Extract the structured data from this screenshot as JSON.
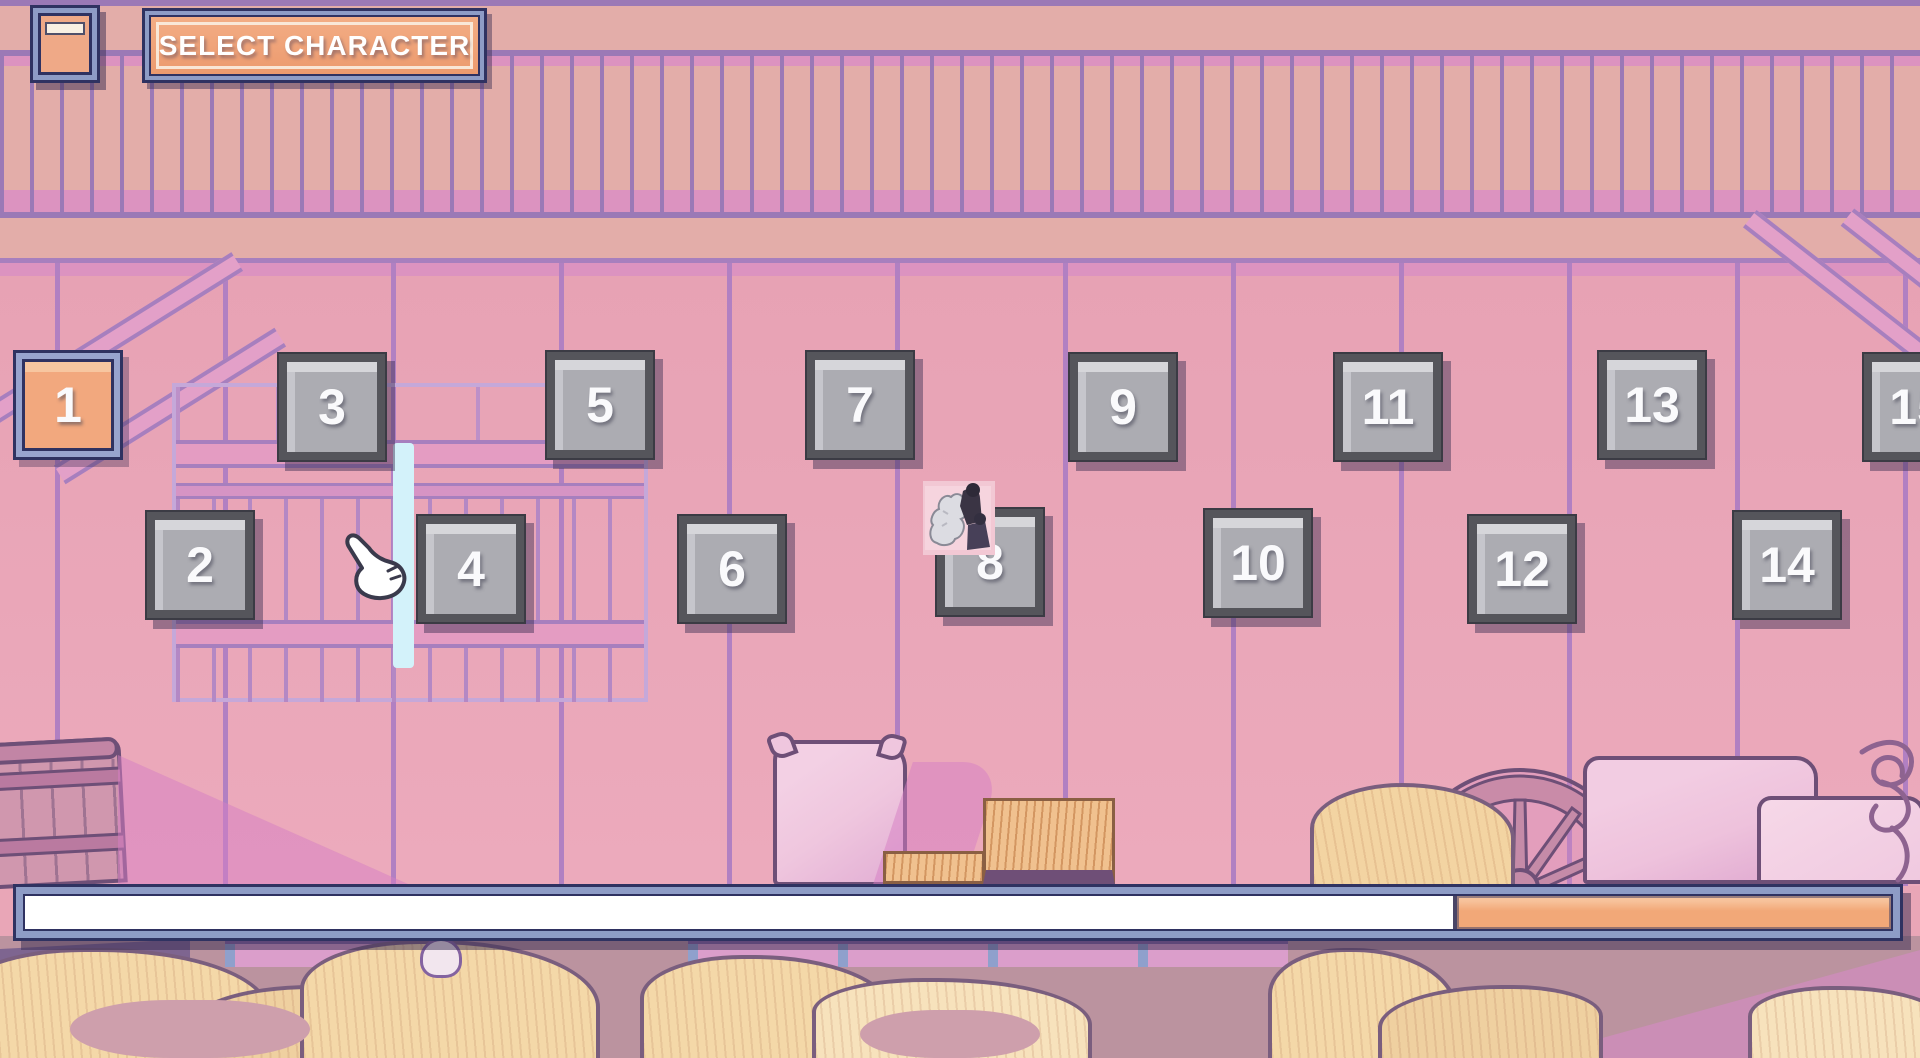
{
  "screen": {
    "name": "character-select",
    "width": 1920,
    "height": 1058
  },
  "header": {
    "menu_button": {
      "icon": "hamburger-icon"
    },
    "title_plate": {
      "label": "SELECT CHARACTER"
    }
  },
  "tiles": [
    {
      "number": "1",
      "selected": true,
      "left": 13,
      "top": 350
    },
    {
      "number": "2",
      "selected": false,
      "left": 145,
      "top": 510
    },
    {
      "number": "3",
      "selected": false,
      "left": 277,
      "top": 352
    },
    {
      "number": "4",
      "selected": false,
      "left": 416,
      "top": 514
    },
    {
      "number": "5",
      "selected": false,
      "left": 545,
      "top": 350
    },
    {
      "number": "6",
      "selected": false,
      "left": 677,
      "top": 514
    },
    {
      "number": "7",
      "selected": false,
      "left": 805,
      "top": 350
    },
    {
      "number": "8",
      "selected": false,
      "left": 935,
      "top": 507
    },
    {
      "number": "9",
      "selected": false,
      "left": 1068,
      "top": 352
    },
    {
      "number": "10",
      "selected": false,
      "left": 1203,
      "top": 508
    },
    {
      "number": "11",
      "selected": false,
      "left": 1333,
      "top": 352
    },
    {
      "number": "12",
      "selected": false,
      "left": 1467,
      "top": 514
    },
    {
      "number": "13",
      "selected": false,
      "left": 1597,
      "top": 350
    },
    {
      "number": "14",
      "selected": false,
      "left": 1732,
      "top": 510
    },
    {
      "number": "15",
      "selected": false,
      "left": 1862,
      "top": 352
    }
  ],
  "overlays": {
    "sprite_thumbnail": {
      "desc": "small character photo over tile 8"
    },
    "hand_cursor": {
      "desc": "white glove pointer between tiles 2 and 4"
    }
  },
  "progress_bar": {
    "remaining_percent": 76.5,
    "elapsed_percent": 23.5,
    "track_color": "#FFFFFF",
    "fill_color": "#F2A878",
    "frame_color": "#8E9CC6"
  },
  "palette": {
    "wall_pink": "#E9A6B7",
    "salmon": "#E3ADA9",
    "purple_line": "#9B79B6",
    "plank_line": "#B180C2",
    "bright_pink": "#DC93C0",
    "navy": "#2F3261",
    "periwinkle": "#8E9CC6",
    "orange": "#F0A678",
    "cream": "#F8F0E3",
    "tile_gray": "#ACACB2",
    "light_gap_cyan": "#D3F2FA"
  },
  "scene": {
    "decorations": [
      "barrel",
      "grain-sack-pillow",
      "hay-bale-small",
      "hay-bale-large",
      "hay-pile",
      "wagon-wheel",
      "grain-sack-big",
      "grain-sack-front",
      "rope-coil",
      "hay-mounds",
      "fence",
      "window-frame",
      "light-gap"
    ]
  }
}
